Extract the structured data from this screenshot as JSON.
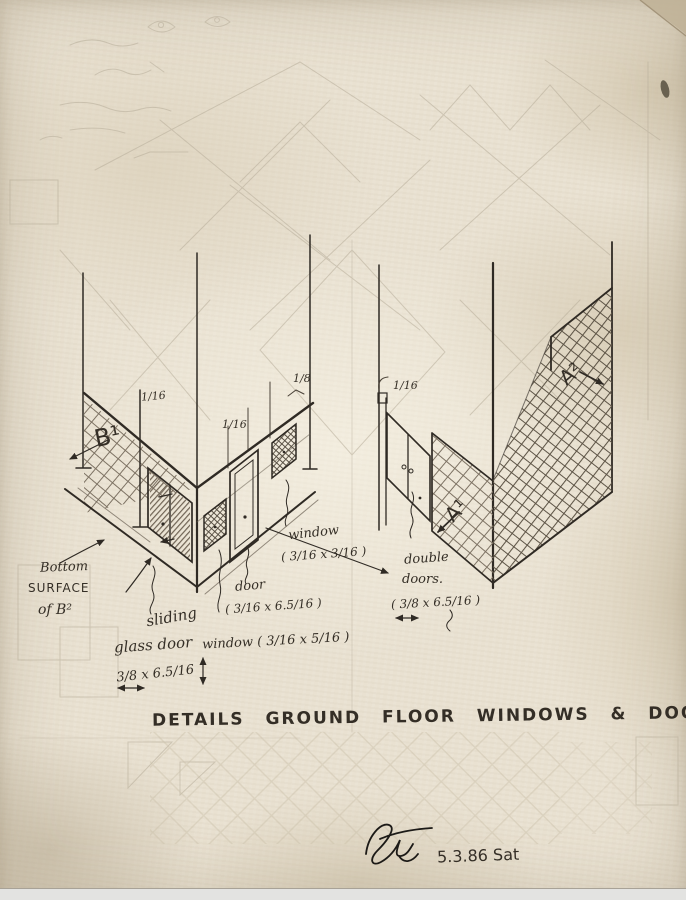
{
  "artwork": {
    "title": "DETAILS GROUND FLOOR WINDOWS & DOORS",
    "date_note": "5.3.86 Sat"
  },
  "markers": {
    "b1": "B¹",
    "a1": "A¹",
    "a2": "A²"
  },
  "dim_labels": {
    "left_wall": "1/16",
    "door_frame": "1/16",
    "window_frame": "1/8",
    "right_wall": "1/16"
  },
  "notes": {
    "bottom_surface": {
      "line1": "Bottom",
      "line2": "SURFACE",
      "line3": "of B²"
    },
    "sliding_door": {
      "line1": "sliding",
      "line2": "glass door",
      "dims": "3/8 x 6.5/16"
    },
    "door": {
      "line1": "door",
      "dims": "( 3/16 x 6.5/16 )"
    },
    "window_lower": {
      "line1": "window ( 3/16 x 5/16 )"
    },
    "window_upper": {
      "line1": "window",
      "dims": "( 3/16 x 3/16 )"
    },
    "double_doors": {
      "line1": "double",
      "line2": "doors.",
      "dims": "( 3/8 x 6.5/16 )"
    }
  }
}
